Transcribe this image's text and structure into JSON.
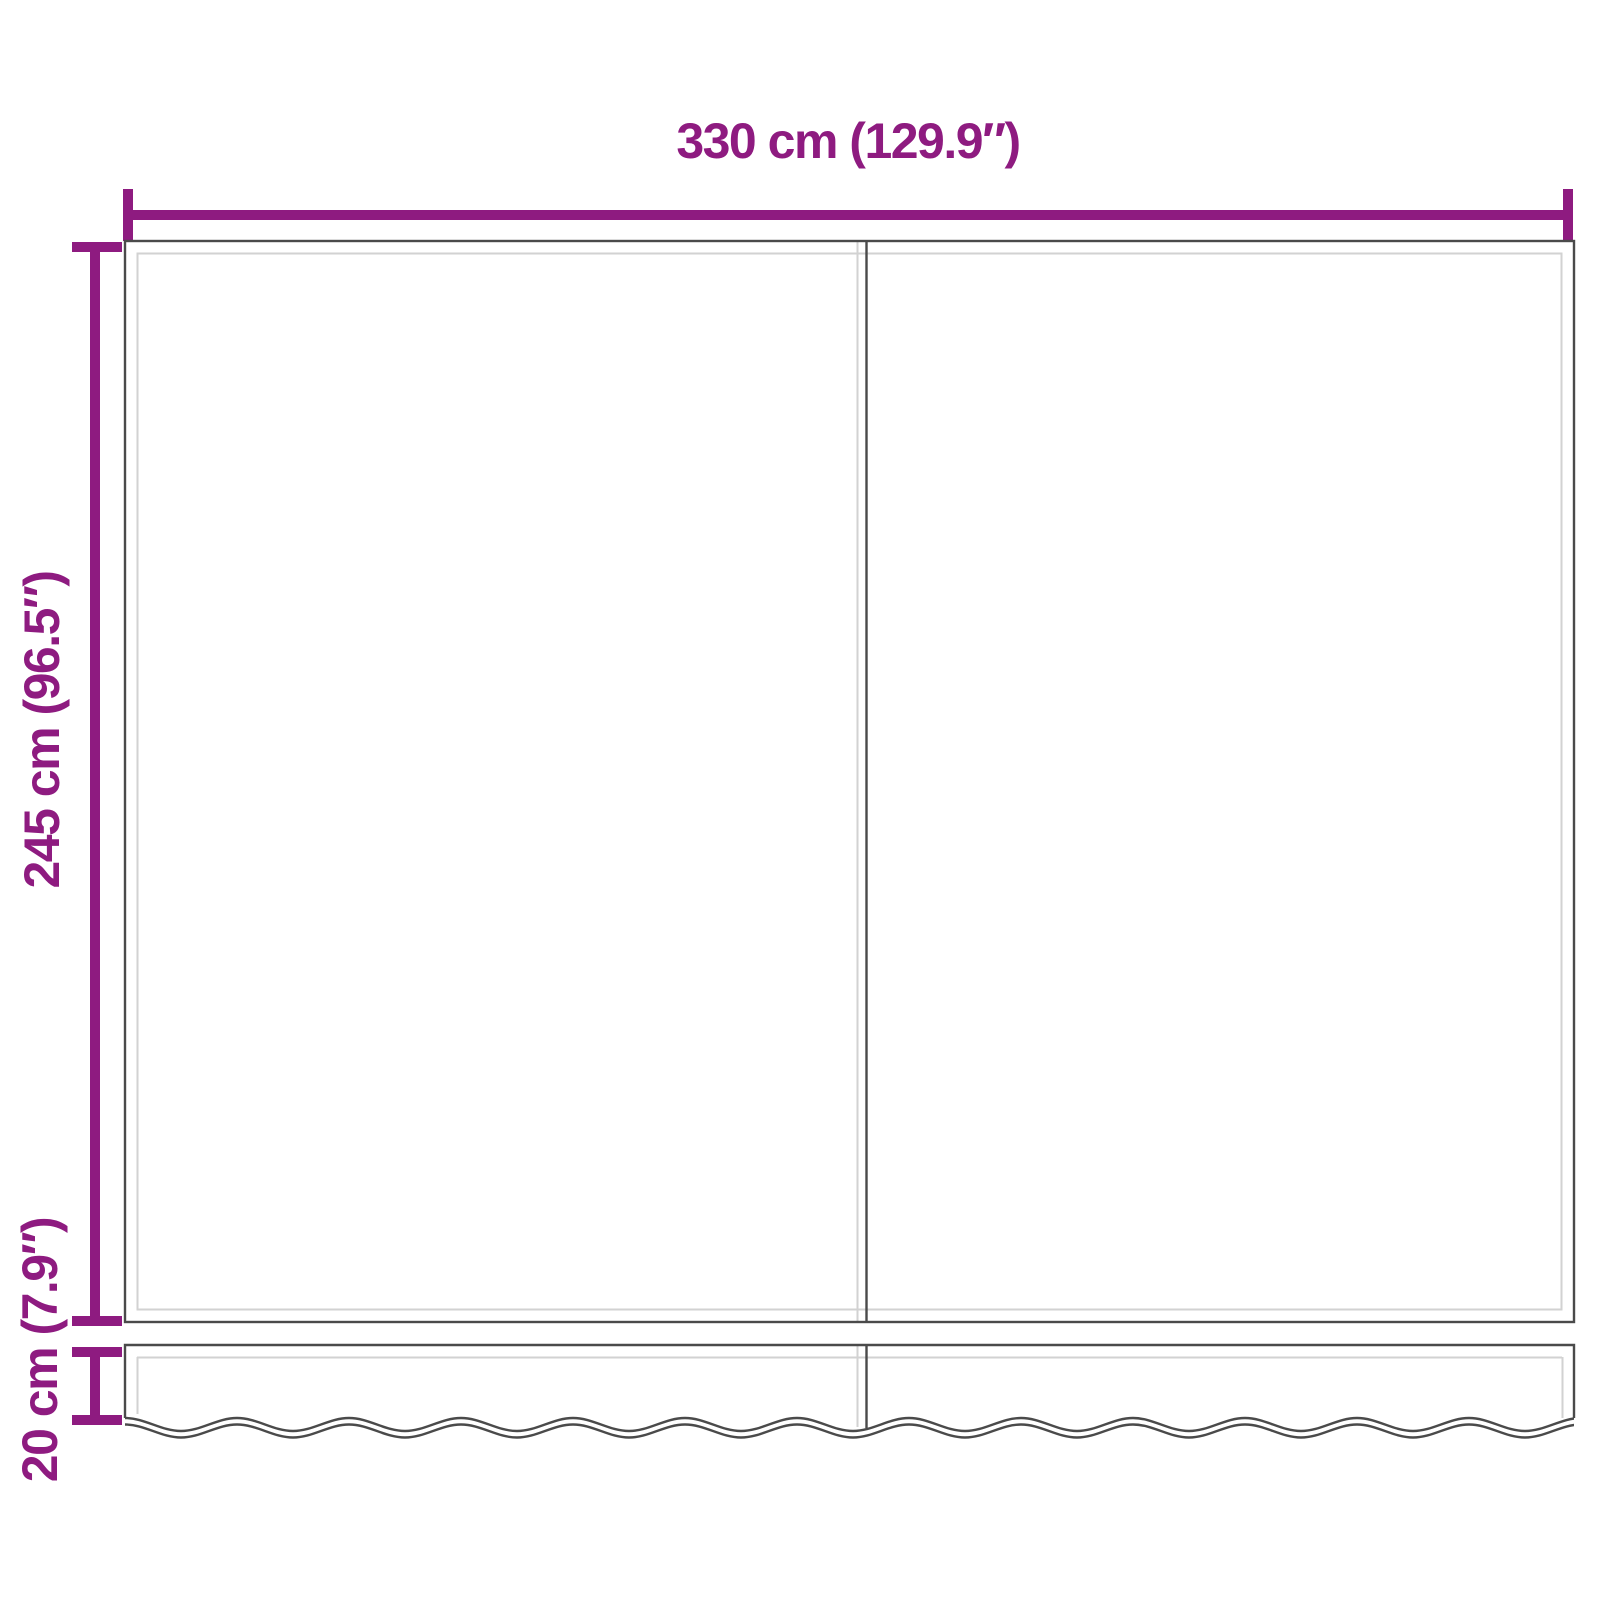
{
  "diagram": {
    "type": "product-dimension-diagram",
    "subject": "Replacement awning fabric (two panels) with scalloped valance"
  },
  "dimensions": {
    "width": {
      "label": "330 cm (129.9″)",
      "orientation": "horizontal"
    },
    "height": {
      "label": "245 cm (96.5″)",
      "orientation": "vertical"
    },
    "valance_height": {
      "label": "20 cm (7.9″)",
      "orientation": "vertical"
    }
  },
  "colors": {
    "dimension_accent": "#8E1B80",
    "fabric_outline": "#4A4A4A",
    "fabric_hem": "#D2D2D2",
    "background": "#FFFFFF"
  }
}
